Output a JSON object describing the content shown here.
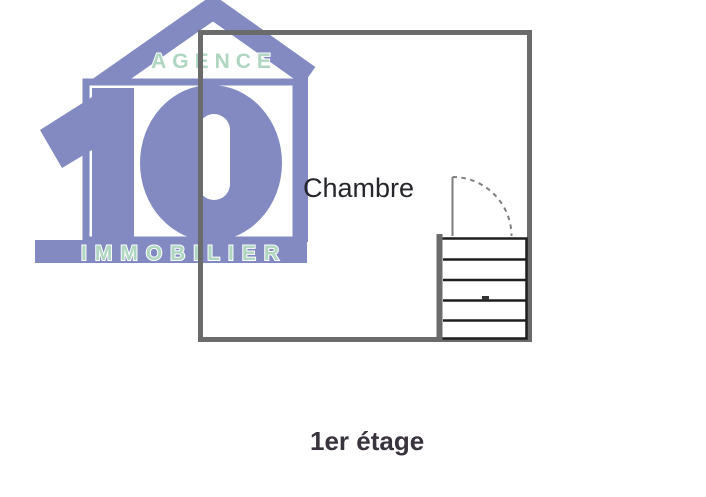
{
  "logo": {
    "top_text": "AGENCE",
    "number": "10",
    "bottom_text": "IMMOBILIER",
    "colors": {
      "purple": "#828ac1",
      "mint": "#aed6c0"
    }
  },
  "plan": {
    "room_label": "Chambre",
    "caption": "1er étage",
    "stair_step_count": 5,
    "colors": {
      "wall": "#6b6b6b",
      "stair": "#1e1e1e",
      "door": "#7e7e7e",
      "room_label": "#25252b",
      "caption": "#39333d"
    }
  }
}
